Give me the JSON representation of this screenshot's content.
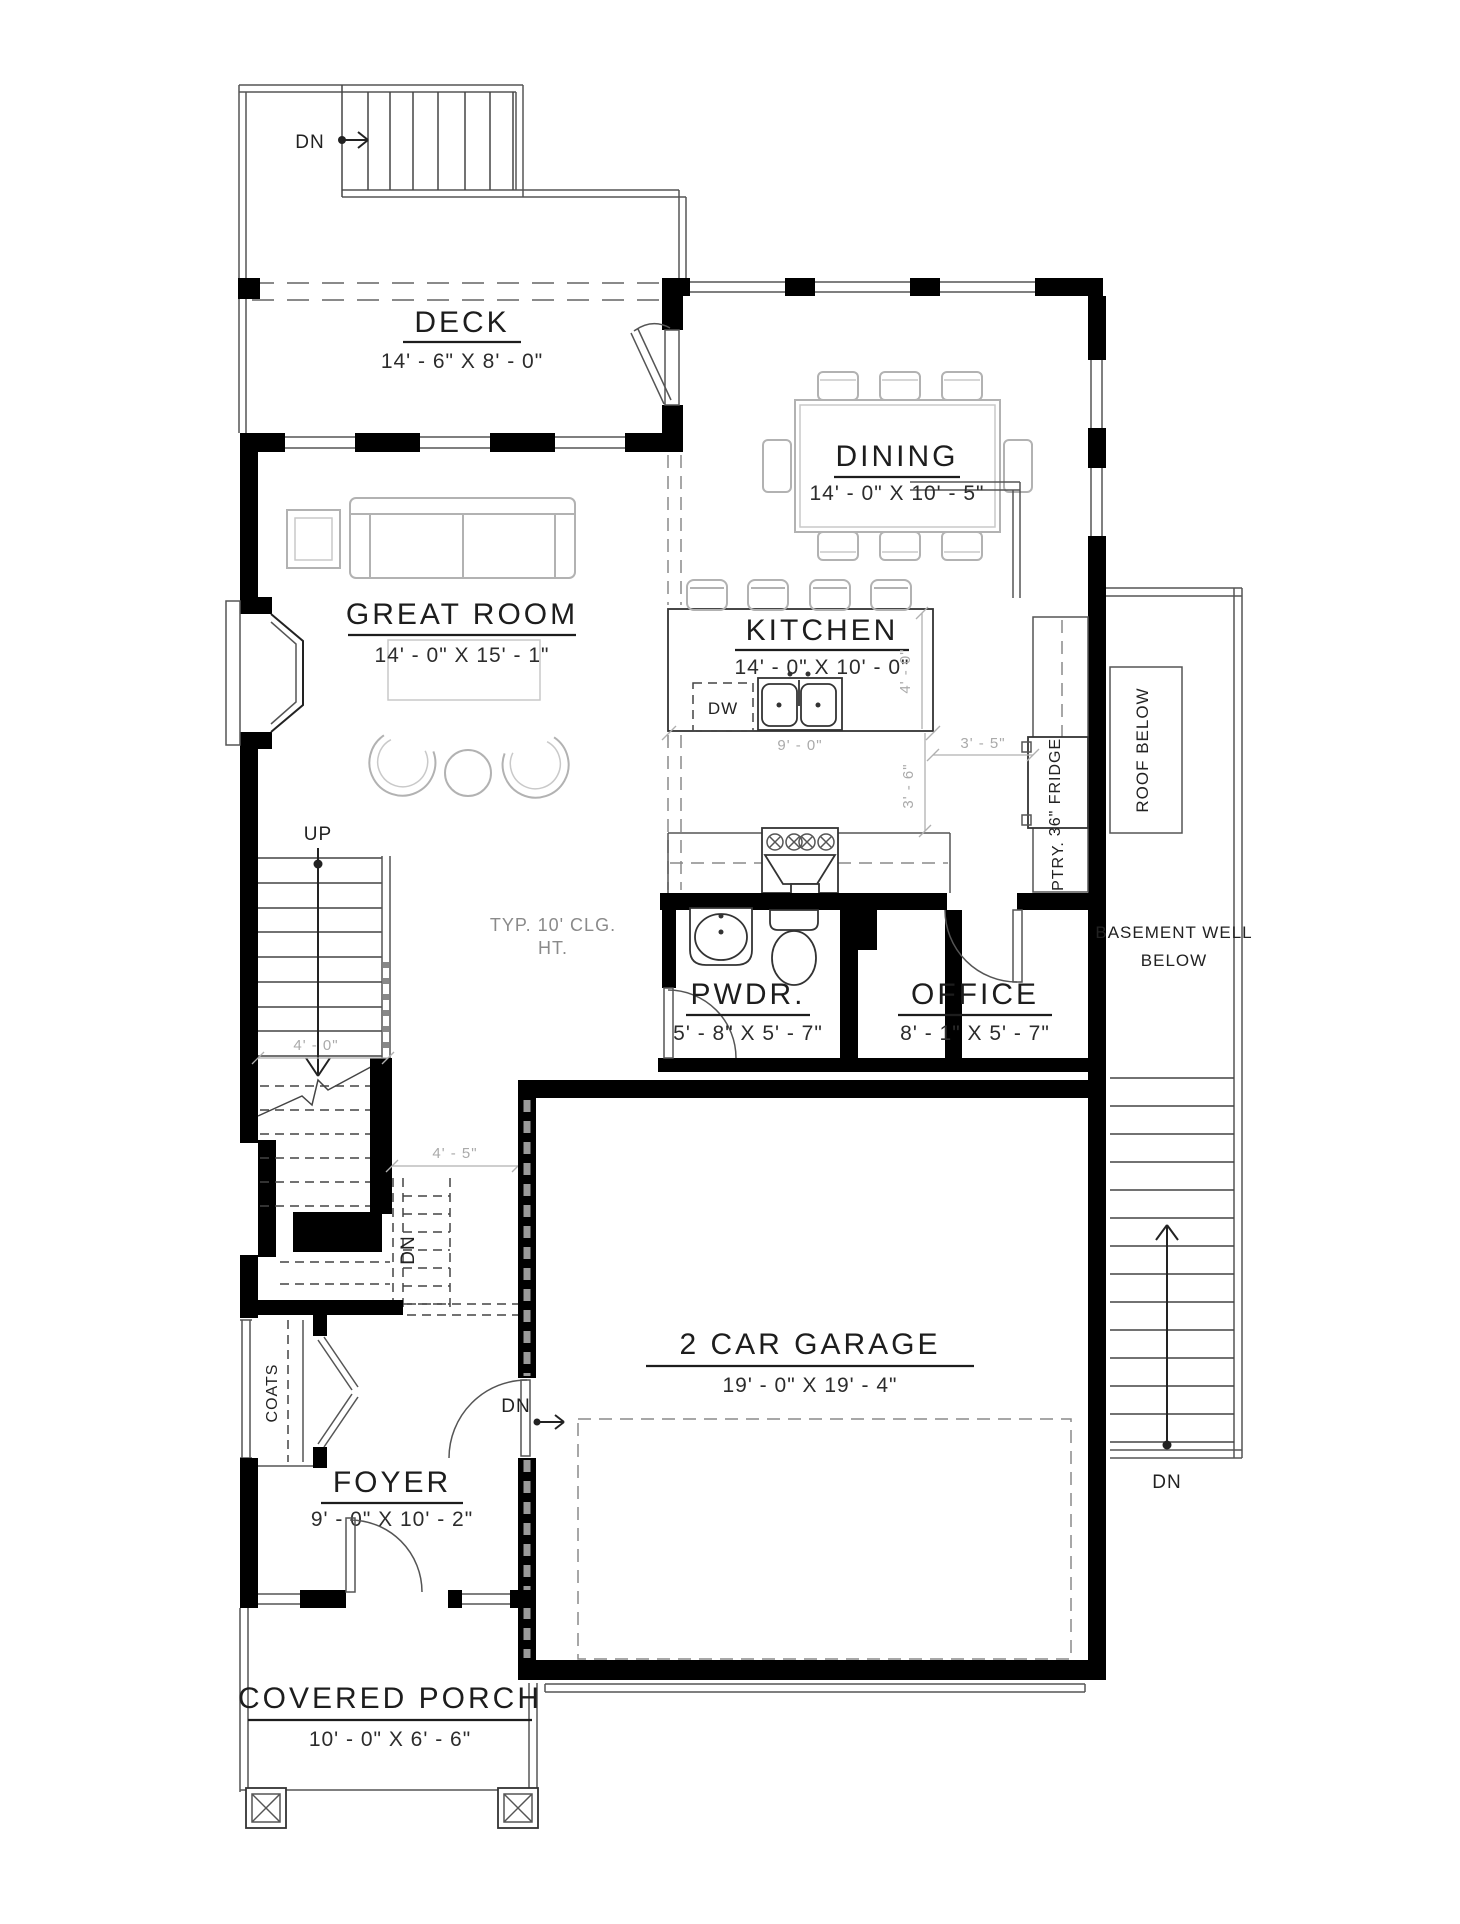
{
  "title": "First Floor Plan",
  "rooms": {
    "deck": {
      "name": "DECK",
      "dims": "14' - 6\" X 8' - 0\""
    },
    "dining": {
      "name": "DINING",
      "dims": "14' - 0\" X 10' - 5\""
    },
    "great_room": {
      "name": "GREAT ROOM",
      "dims": "14' - 0\" X 15' - 1\""
    },
    "kitchen": {
      "name": "KITCHEN",
      "dims": "14' - 0\" X 10' - 0\""
    },
    "pwdr": {
      "name": "PWDR.",
      "dims": "5' - 8\" X 5' - 7\""
    },
    "office": {
      "name": "OFFICE",
      "dims": "8' - 1\" X 5' - 7\""
    },
    "garage": {
      "name": "2 CAR GARAGE",
      "dims": "19' - 0\" X 19' - 4\""
    },
    "foyer": {
      "name": "FOYER",
      "dims": "9' - 0\" X 10' - 2\""
    },
    "covered_porch": {
      "name": "COVERED PORCH",
      "dims": "10' - 0\" X 6' - 6\""
    }
  },
  "annotations": {
    "dn": "DN",
    "up": "UP",
    "ceiling_note_line1": "TYP. 10' CLG.",
    "ceiling_note_line2": "HT.",
    "roof_below": "ROOF BELOW",
    "basement_well_line1": "BASEMENT WELL",
    "basement_well_line2": "BELOW",
    "pantry": "PTRY.",
    "fridge": "36\" FRIDGE",
    "coats": "COATS",
    "dishwasher": "DW"
  },
  "dimensions": {
    "stair_width": "4' - 0\"",
    "hall_width": "4' - 5\"",
    "island_length": "9' - 0\"",
    "island_depth": "4' - 0\"",
    "island_to_pantry": "3' - 5\"",
    "counter_aisle": "3' - 6\""
  },
  "colors": {
    "wall": "#000000",
    "line": "#444444",
    "furniture": "#b2b2b2",
    "dashed": "#8a8a8a",
    "dim_text": "#aaaaaa",
    "label_text": "#1d1d1d",
    "background": "#ffffff"
  }
}
